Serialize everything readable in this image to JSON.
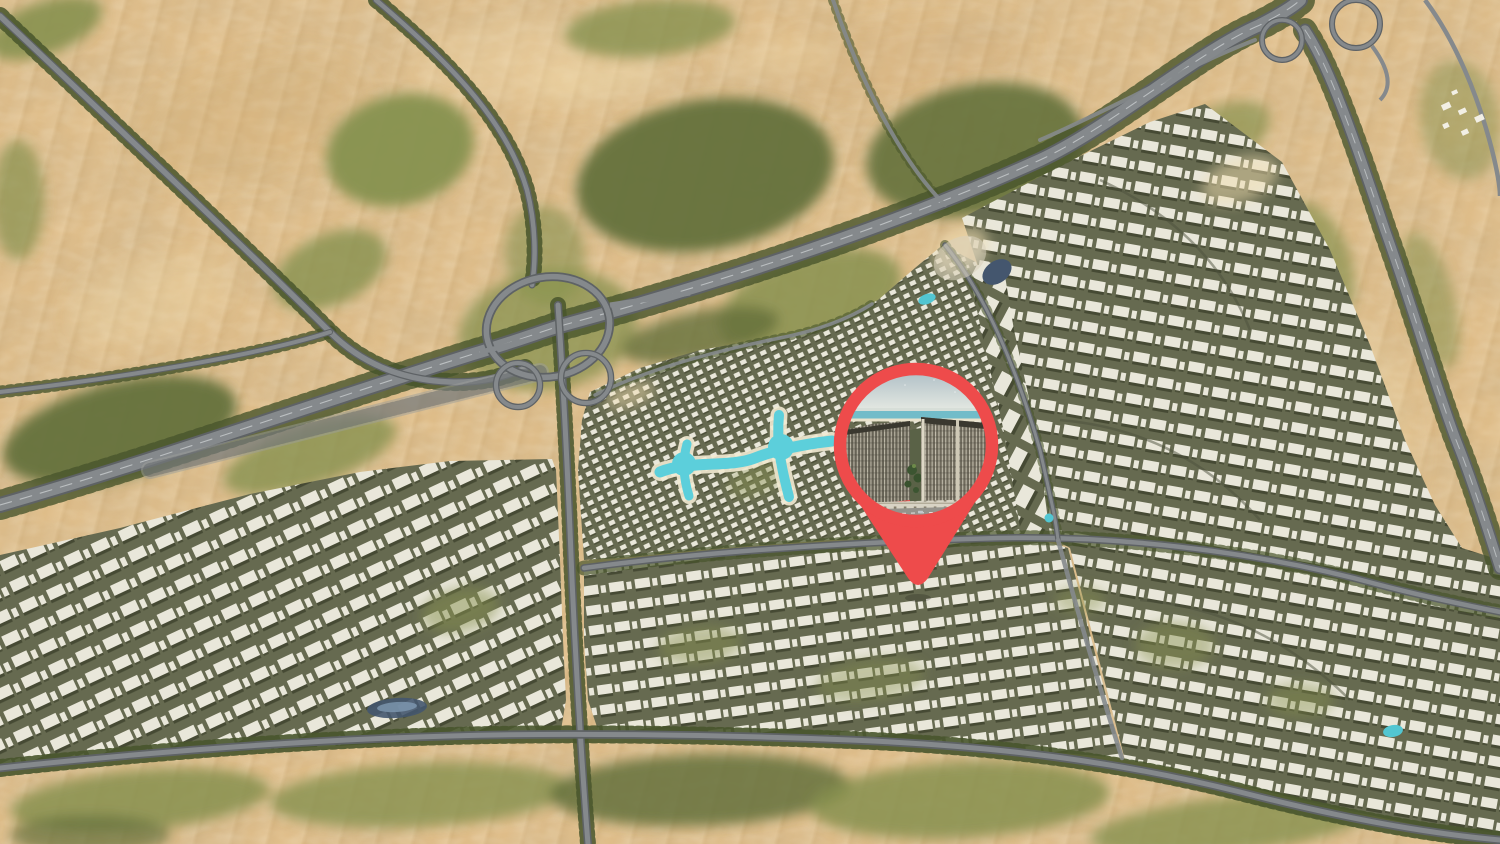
{
  "map": {
    "kind": "aerial-masterplan-map",
    "scene": "desert-city-development-render",
    "colors": {
      "sand": "#dfbd89",
      "sand_light": "#f2ddb0",
      "sand_dark": "#c7a26b",
      "veg": "#87914f",
      "veg_dark": "#64713c",
      "veg_deep": "#48552c",
      "road": "#85898c",
      "road_dark": "#5e6265",
      "road_light": "#9b9e9a",
      "median": "#cdd1d3",
      "city_street": "#666a50",
      "building": "#e9e7da",
      "building_shadow": "#41442f",
      "lagoon": "#5ccfdb",
      "beach": "#f2ead2",
      "pond": "#44566e",
      "pool": "#52c6d2",
      "white_structure": "#f2efe5"
    },
    "features": [
      {
        "name": "desert-dunes"
      },
      {
        "name": "vegetation-patches"
      },
      {
        "name": "cloverleaf-interchange"
      },
      {
        "name": "main-highway"
      },
      {
        "name": "east-highway"
      },
      {
        "name": "tree-lined-boulevards"
      },
      {
        "name": "villa-district"
      },
      {
        "name": "turquoise-lagoon"
      },
      {
        "name": "west-apartment-district"
      },
      {
        "name": "east-masterplan-district"
      },
      {
        "name": "south-apartment-band"
      },
      {
        "name": "desert-camp-structures"
      },
      {
        "name": "ponds-and-pools"
      }
    ]
  },
  "pin": {
    "name": "location-pin",
    "color": "#ee4b4b",
    "photo": {
      "subject": "apartment-complex-render",
      "colors": {
        "sky_top": "#b3c2c8",
        "sky_bottom": "#e6eae3",
        "sea": "#72bcc9",
        "beach_line": "#eae3cd",
        "facade_left": "#676356",
        "facade_right": "#6f6a5c",
        "parapet": "#3a382f",
        "mullion": "#ddd8c6",
        "courtyard": "#3c5531",
        "tree": "#39522e",
        "arcade": "#d8d3c4",
        "arcade_shadow": "#857e6a",
        "street": "#95938c",
        "lane": "#ffffff"
      }
    }
  }
}
